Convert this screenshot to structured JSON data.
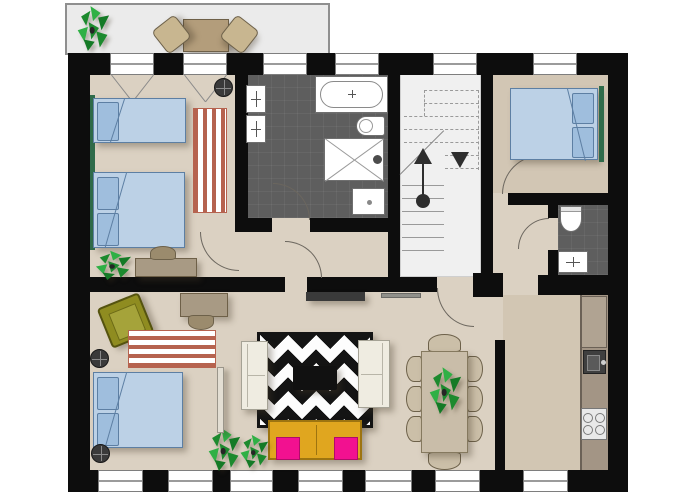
{
  "meta": {
    "kind": "apartment-floor-plan-top-view",
    "visible_text": "none"
  },
  "palette": {
    "background": "#ffffff",
    "wall": "#0d0d0d",
    "floor_main": "#dbd1c2",
    "floor_right_rooms": "#d2c6b4",
    "floor_bath_wc": "#5e5e5e",
    "floor_staircase": "#f0f0f0",
    "floor_balcony": "#ebebeb",
    "bed_mattress": "#bcd1e6",
    "bed_pillow": "#9fbedd",
    "rug_stripe": "#b6634f",
    "chevron_rug": "#141414",
    "sofa_white": "#efece1",
    "sofa_yellow": "#e0a61f",
    "cushion_pink": "#f21190",
    "armchair_olive": "#8f8c20",
    "desk_wood": "#a89a84",
    "dining_wood": "#c9bda9",
    "kitchen_counter": "#a39585",
    "plant_green": "#1c8a2e",
    "curtain_green": "#2f6b4a"
  },
  "rooms": [
    {
      "name": "balcony",
      "furniture": [
        "plant",
        "bistro-table",
        "chair",
        "chair"
      ]
    },
    {
      "name": "bedroom-top-left",
      "furniture": [
        "single-bed",
        "double-bed",
        "striped-rug",
        "desk",
        "chair",
        "plant",
        "round-side-table",
        "curtain"
      ]
    },
    {
      "name": "bathroom",
      "furniture": [
        "bathtub",
        "toilet",
        "shower",
        "washbasin",
        "cabinet",
        "cabinet"
      ]
    },
    {
      "name": "staircase",
      "furniture": [
        "up-arrow",
        "down-arrow",
        "treads-solid",
        "treads-dashed"
      ]
    },
    {
      "name": "bedroom-top-right",
      "furniture": [
        "double-bed",
        "curtain"
      ]
    },
    {
      "name": "wc",
      "furniture": [
        "toilet",
        "washbasin"
      ]
    },
    {
      "name": "hallway",
      "furniture": [
        "entrance-door",
        "interior-doors"
      ]
    },
    {
      "name": "bedroom-bottom-left",
      "furniture": [
        "double-bed",
        "striped-rug",
        "olive-armchair",
        "desk",
        "chair",
        "round-side-table",
        "round-side-table",
        "partition"
      ]
    },
    {
      "name": "living-room",
      "furniture": [
        "chevron-rug",
        "coffee-table",
        "white-sofa",
        "white-sofa",
        "yellow-sofa",
        "pink-cushion",
        "pink-cushion",
        "console",
        "console",
        "plant",
        "plant"
      ]
    },
    {
      "name": "dining-area",
      "furniture": [
        "dining-table",
        "eight-chairs",
        "plant"
      ]
    },
    {
      "name": "kitchen",
      "furniture": [
        "counter",
        "sink",
        "stove"
      ]
    }
  ],
  "windows": {
    "top_wall": 6,
    "bottom_wall": 7,
    "casement_marks_on_balcony_windows": 2
  },
  "doors": {
    "arcs": 6,
    "apartment_entrance_from_staircase": 1
  }
}
